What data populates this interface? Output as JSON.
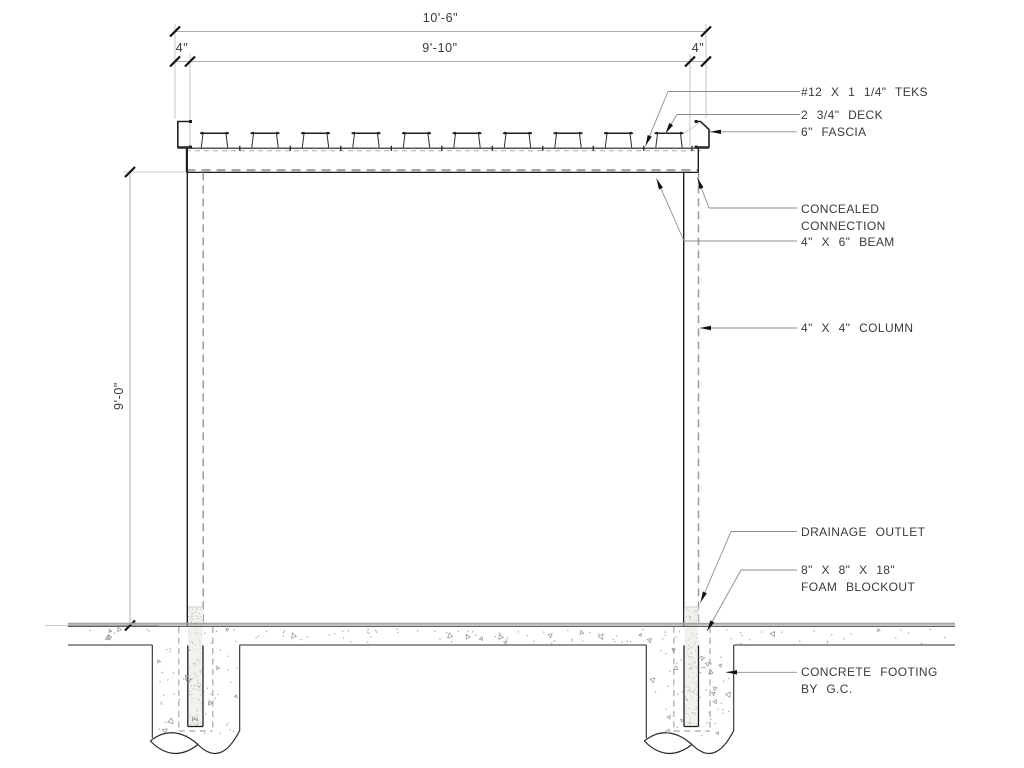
{
  "title": "Shade structure section detail",
  "dimensions": {
    "overall_width": "10'-6\"",
    "left_offset": "4\"",
    "inner_width": "9'-10\"",
    "right_offset": "4\"",
    "column_height": "9'-0\""
  },
  "callouts": {
    "teks": "#12 X 1 1/4\" TEKS",
    "deck": "2 3/4\" DECK",
    "fascia": "6\" FASCIA",
    "concealed_line1": "CONCEALED",
    "concealed_line2": "CONNECTION",
    "beam": "4\" X 6\" BEAM",
    "column": "4\" X 4\" COLUMN",
    "drainage": "DRAINAGE OUTLET",
    "foam_line1": "8\" X 8\" X 18\"",
    "foam_line2": "FOAM BLOCKOUT",
    "footing_line1": "CONCRETE FOOTING",
    "footing_line2": "BY G.C."
  },
  "colors": {
    "background": "#ffffff",
    "line": "#1f1f1f",
    "outline": "#2a2a2a",
    "hidden": "#9b9b9b",
    "hidden_heavy": "#a8a8a8",
    "leader": "#8c8c8c",
    "extension": "#b8b8b8",
    "dimline": "#ababab",
    "tick": "#111111",
    "arrow": "#111111",
    "text": "#3a3a3a",
    "stipple": "#9e9e9e",
    "stipple_tri": "#8f8f8f",
    "fill_concrete": "#f2f1ed",
    "fill_dots": "#b8b4ac",
    "ground_gray": "#a3a3a3"
  }
}
